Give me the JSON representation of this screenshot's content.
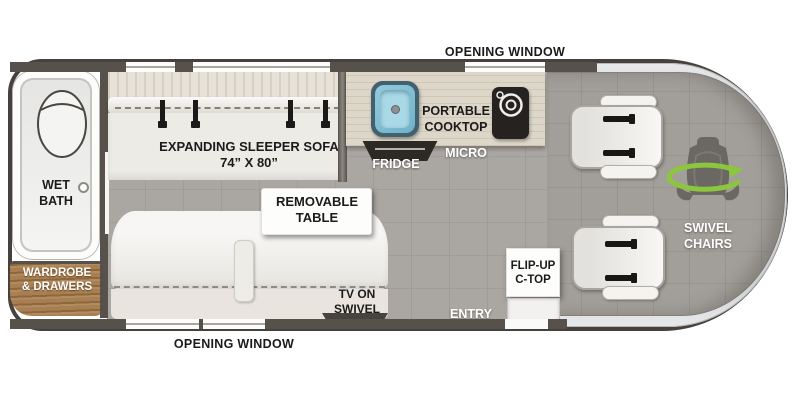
{
  "floorplan": {
    "exterior": {
      "opening_window_top": "OPENING WINDOW",
      "opening_window_bottom": "OPENING WINDOW"
    },
    "rear": {
      "wet_bath_line1": "WET",
      "wet_bath_line2": "BATH",
      "wardrobe_line1": "WARDROBE",
      "wardrobe_line2": "& DRAWERS"
    },
    "lounge": {
      "sleeper_sofa_line1": "EXPANDING SLEEPER SOFA",
      "sleeper_sofa_line2": "74” X 80”",
      "removable_table_line1": "REMOVABLE",
      "removable_table_line2": "TABLE",
      "tv_line1": "TV ON",
      "tv_line2": "SWIVEL"
    },
    "galley": {
      "portable_cooktop_line1": "PORTABLE",
      "portable_cooktop_line2": "COOKTOP",
      "fridge_label": "FRIDGE",
      "micro_label": "MICRO",
      "flip_up_ctop_line1": "FLIP-UP",
      "flip_up_ctop_line2": "C-TOP",
      "entry_label": "ENTRY"
    },
    "cab": {
      "swivel_chairs_line1": "SWIVEL",
      "swivel_chairs_line2": "CHAIRS"
    },
    "icons": {
      "toilet": "toilet-icon",
      "sink": "sink-icon",
      "burner": "cooktop-burner-icon",
      "seatbelt": "seatbelt-icon",
      "swivel_chair": "swivel-chair-icon",
      "rotate_arrow": "rotate-arrow-icon",
      "tv": "tv-icon",
      "shower_drain": "shower-drain-icon"
    },
    "colors": {
      "body_outline": "#46413c",
      "wall": "#57514b",
      "floor": "#aaa6a1",
      "cab_floor": "#a29e99",
      "counter_wood": "#ddd7ca",
      "wardrobe_wood": "#a87f52",
      "sofa": "#f3f2ef",
      "sink_blue": "#7fc0d8",
      "accent_green": "#8cc63e",
      "windshield_silver": "#d9dadc"
    }
  }
}
